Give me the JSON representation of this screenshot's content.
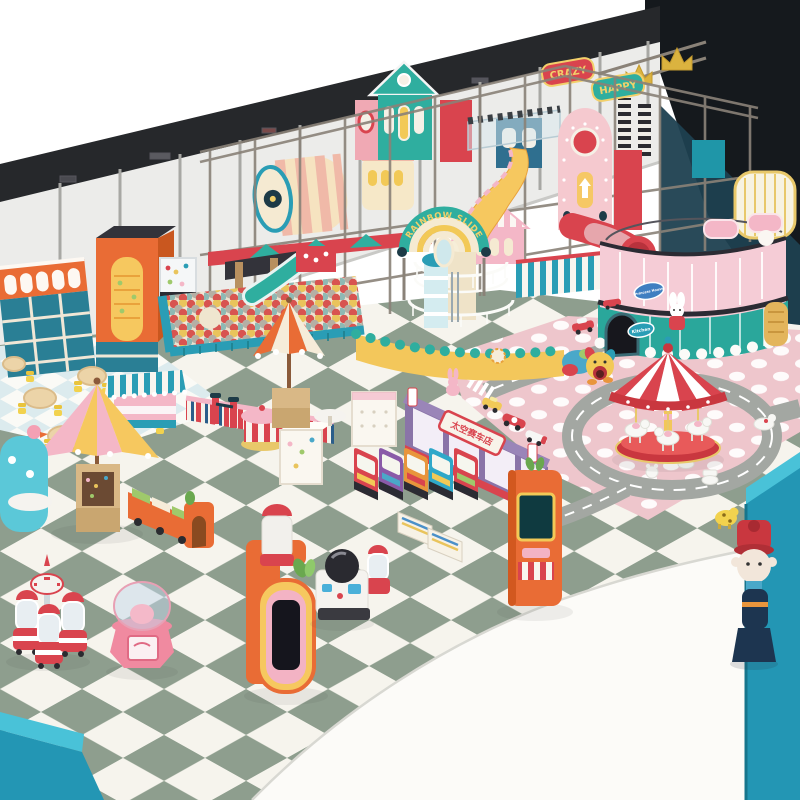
{
  "scene": {
    "type": "indoor-playground-3d-render",
    "signs": {
      "crazy": "CRAZY",
      "happy": "HAPPY",
      "rainbow_slide": "RAINBOW SLIDE",
      "princess_house": "Princess House",
      "kitchen": "Kitchen",
      "racing_shop": "太空赛车店"
    },
    "palette": {
      "floor_sage": "#8e9e8e",
      "floor_white": "#f6f4ed",
      "small_tile_blue": "#dcebee",
      "mat_pink": "#eec6cc",
      "road_gray": "#a3a7a2",
      "frame_gray": "#8a8278",
      "wall_white": "#ececea",
      "wall_band_dark": "#26282b",
      "corner_dark": "#15191d",
      "teal": "#2fae9f",
      "aqua": "#2a9db5",
      "red": "#d9444e",
      "pink": "#f4b7c7",
      "yellow": "#f2c957",
      "cream": "#f5ead2",
      "orange": "#e96c35",
      "purple": "#8a74a8",
      "wall_teal": "#2396b4",
      "gold": "#dbb33f"
    }
  }
}
